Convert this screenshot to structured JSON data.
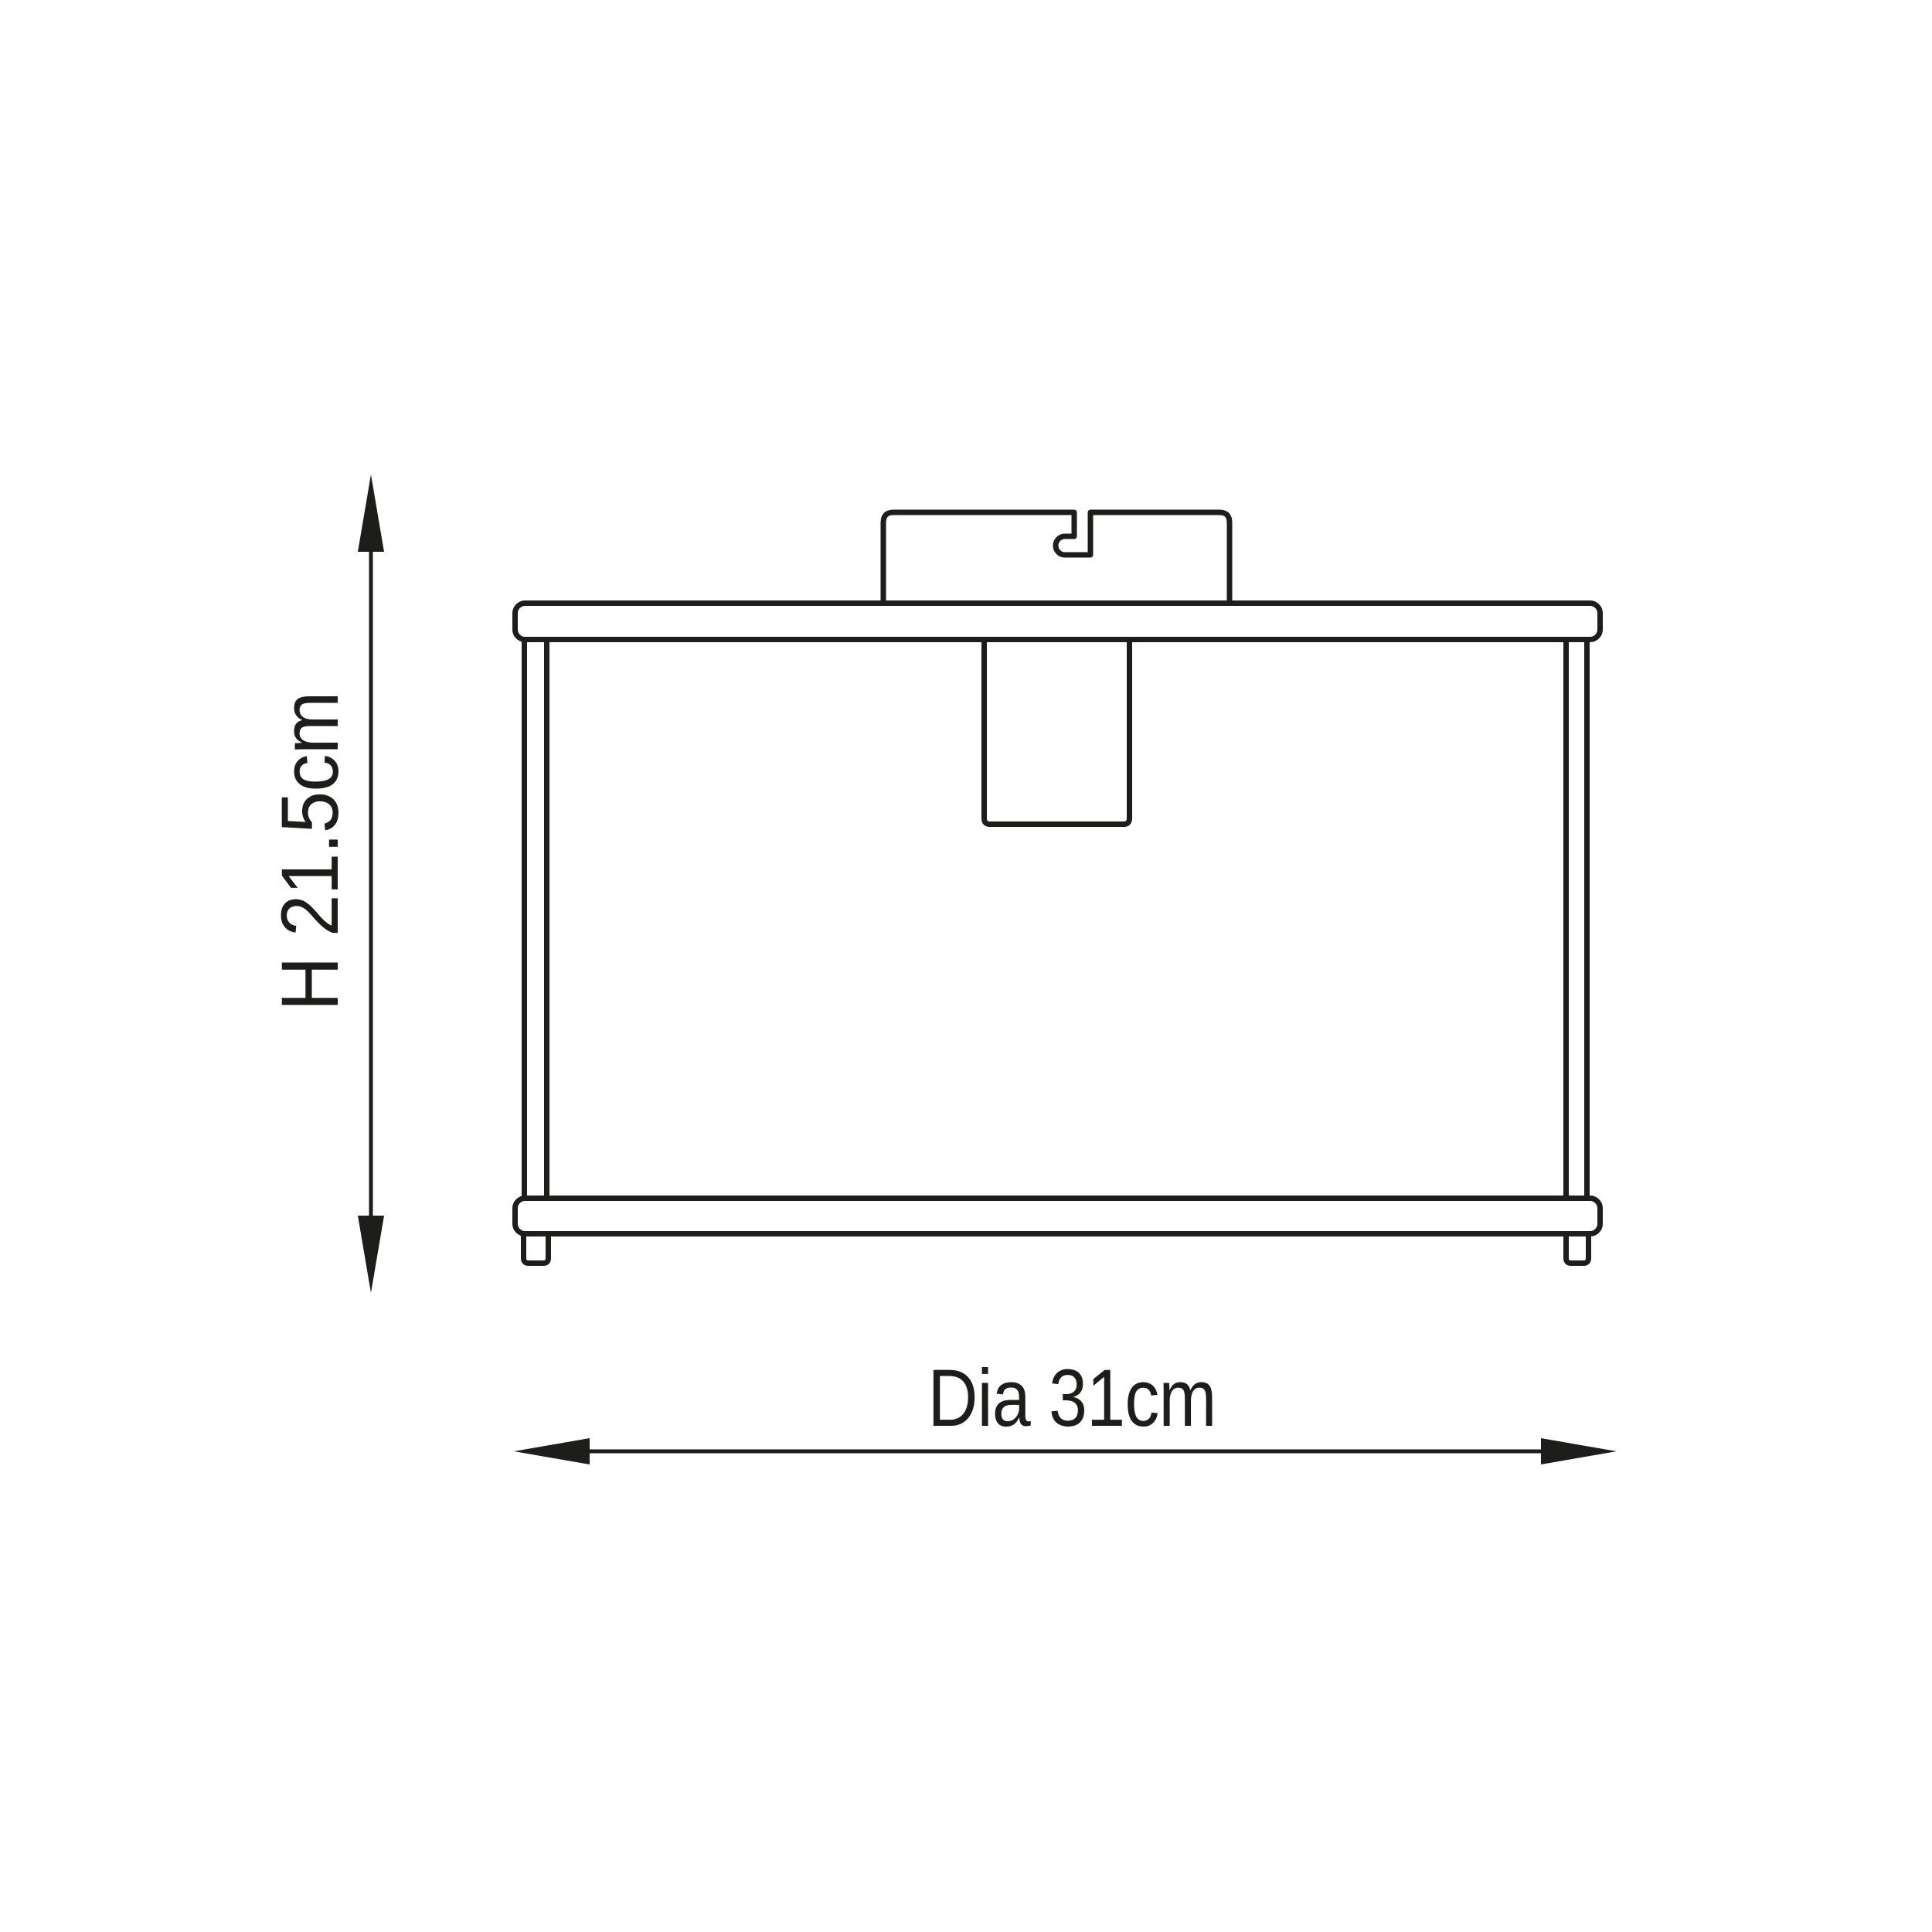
{
  "page": {
    "background_color": "#ffffff",
    "ink_color": "#1d1d1b"
  },
  "diagram": {
    "kind": "product-dimension-line-drawing",
    "subject": "flush ceiling light fixture, side elevation",
    "height_dimension": {
      "label": "H 21.5cm",
      "value_cm": 21.5,
      "orientation": "vertical"
    },
    "diameter_dimension": {
      "label": "Dia 31cm",
      "value_cm": 31,
      "orientation": "horizontal"
    }
  }
}
